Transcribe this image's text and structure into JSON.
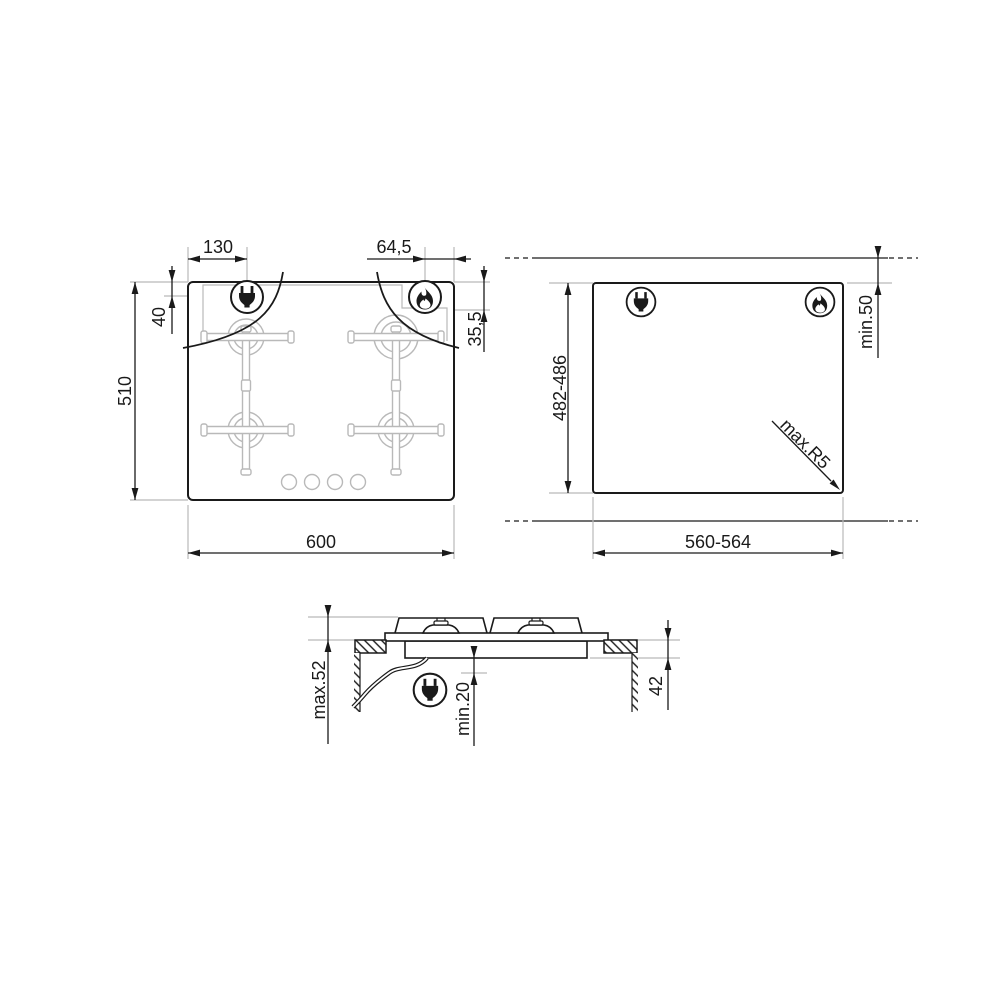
{
  "colors": {
    "ink": "#1a1a1a",
    "light_gray": "#b9b9b9",
    "background": "#ffffff"
  },
  "icons": {
    "plug": "power-plug-icon",
    "flame": "gas-flame-icon"
  },
  "plan_view": {
    "plug_offset_x": "130",
    "flame_offset_x": "64,5",
    "plug_offset_y": "40",
    "flame_offset_y": "35,5",
    "height": "510",
    "width": "600"
  },
  "cutout_view": {
    "height": "482-486",
    "width": "560-564",
    "rear_clearance": "min.50",
    "corner_radius": "max.R5"
  },
  "side_view": {
    "height_above_top": "max.52",
    "clearance_below": "min.20",
    "build_in_depth": "42"
  }
}
